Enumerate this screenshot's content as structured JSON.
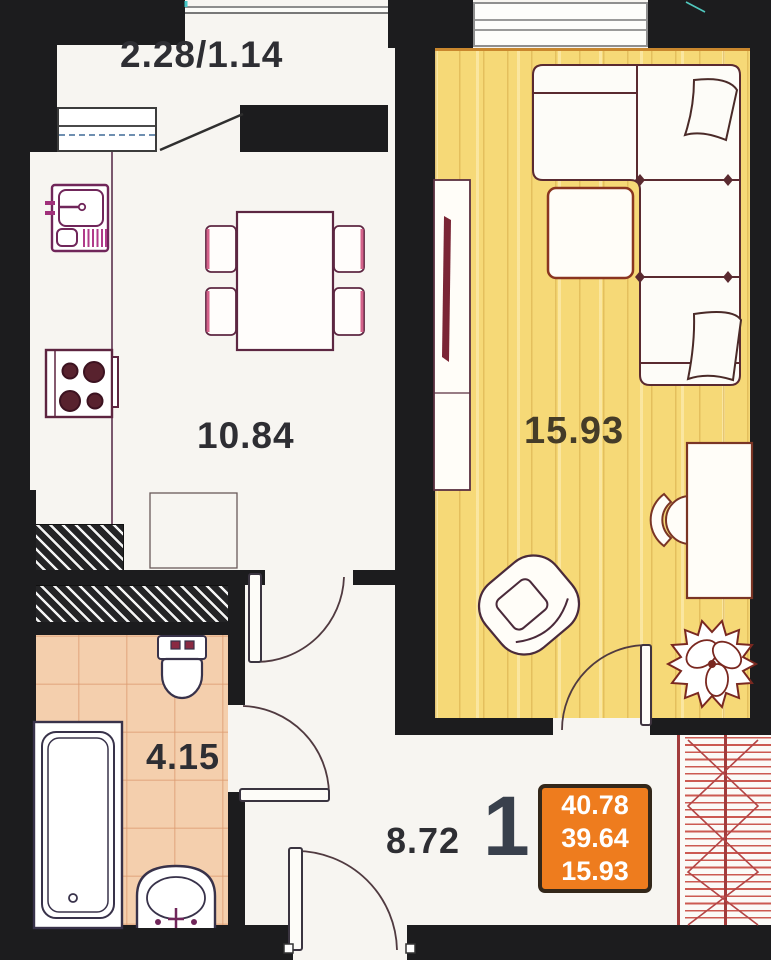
{
  "plan": {
    "title": "one-room apartment floor plan",
    "balcony": {
      "dims": "2.28/1.14"
    },
    "kitchen": {
      "area": "10.84"
    },
    "living_room": {
      "area": "15.93"
    },
    "bathroom": {
      "area": "4.15"
    },
    "hallway": {
      "area": "8.72"
    },
    "summary_badge": {
      "rooms_count": "1",
      "values": [
        "40.78",
        "39.64",
        "15.93"
      ]
    },
    "colors": {
      "wall": "#1c1c1e",
      "floor_wood": "#f6d977",
      "floor_tile": "#f4cfad",
      "badge_orange": "#ee7c1e",
      "stair_red": "#b34545",
      "fixture_magenta": "#8d2f67",
      "furniture_brown": "#6d2f26"
    },
    "icons": [
      "kitchen-sink-icon",
      "stove-icon",
      "dining-table-icon",
      "chair-icon",
      "sofa-icon",
      "pillow-icon",
      "ottoman-icon",
      "tv-unit-icon",
      "desk-icon",
      "desk-chair-icon",
      "armchair-icon",
      "plant-icon",
      "toilet-icon",
      "bathtub-icon",
      "wash-basin-icon",
      "door-swing-icon",
      "stairs-icon",
      "window-icon",
      "vent-shaft-icon",
      "balcony-railing-icon"
    ]
  }
}
